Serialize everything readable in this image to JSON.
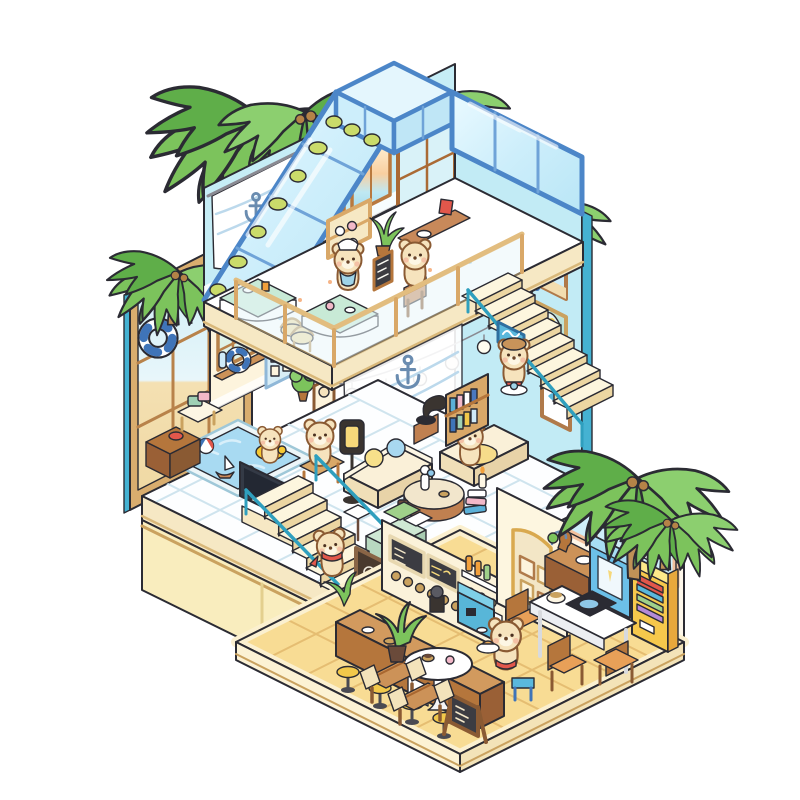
{
  "scene": {
    "type": "isometric-illustration",
    "subject": "three-story cutaway beach coffee house inhabited by cream bears",
    "signs": {
      "coffee_wall": "coffee"
    },
    "palette": {
      "outline": "#2b2b33",
      "wall_cyan": "#c6edf6",
      "wall_cyan_deep": "#bfe9f3",
      "teal_edge": "#45b2d2",
      "cream_wall": "#fdf4dd",
      "slab_cream": "#f6e8c4",
      "trim_tan": "#d9b87a",
      "exterior_yellow": "#f9edbe",
      "floor_yellow": "#f8dc94",
      "tile_grout": "#e5bd72",
      "glass": "#d9f1fb",
      "roof_frame": "#4c86c8",
      "mint": "#c8ead6",
      "wood": "#cc9258",
      "wood_dark": "#b5763c",
      "leaf_green": "#7cc35c",
      "leaf_dark": "#5fae49",
      "trunk": "#bf9157",
      "bear_fur": "#f6e3bd",
      "bear_line": "#8a5a33",
      "red": "#e2574b",
      "sky_blue": "#5ab8dc",
      "navy": "#3f74b8",
      "pink": "#f2b8c8",
      "stool_yellow": "#f2c84a",
      "pool_water": "#a8daf2",
      "sign_text": "#8a5428"
    },
    "objects": [
      "palm-trees",
      "glass-gable-roof",
      "roof-skylight",
      "ivy-garland",
      "rooftop-cafe-tables",
      "wicker-chairs",
      "bear-waiter",
      "bear-customer",
      "pastry-display",
      "menu-chalkboard",
      "anchor-curtain",
      "ac-unit",
      "sunset-windows",
      "coffee-cloud-sign",
      "ships-wheel",
      "wall-art-frames",
      "loft-railing",
      "string-lights",
      "upper-staircase",
      "bear-with-tray",
      "wave-signboard",
      "beach-picture-window",
      "pennant-bunting",
      "lifebuoy",
      "lattice-window",
      "bulletin-board",
      "bear-portrait",
      "swimming-pool",
      "beach-ball",
      "toy-sailboat",
      "rubber-duck",
      "bear-in-swim-ring",
      "tv-cabinet",
      "storage-chest",
      "cream-sofas",
      "lounging-bear",
      "round-coffee-table",
      "book-stack-candle",
      "bookshelf",
      "gramophone",
      "floor-lantern",
      "bear-on-chair",
      "music-stand",
      "coffee-cart",
      "lower-staircase",
      "bear-climbing-stairs",
      "latte-art-panel",
      "bar-menu-boards",
      "syrup-shelves",
      "espresso-machine",
      "bar-counter",
      "bar-stools",
      "arch-gallery-wall",
      "sideboard",
      "dining-table",
      "induction-cooktop",
      "wooden-chairs",
      "vending-machine",
      "ice-cream-freezer",
      "cafe-round-table",
      "bear-barista",
      "a-frame-sign",
      "wooden-benches",
      "monstera-plant",
      "picture-window"
    ]
  }
}
